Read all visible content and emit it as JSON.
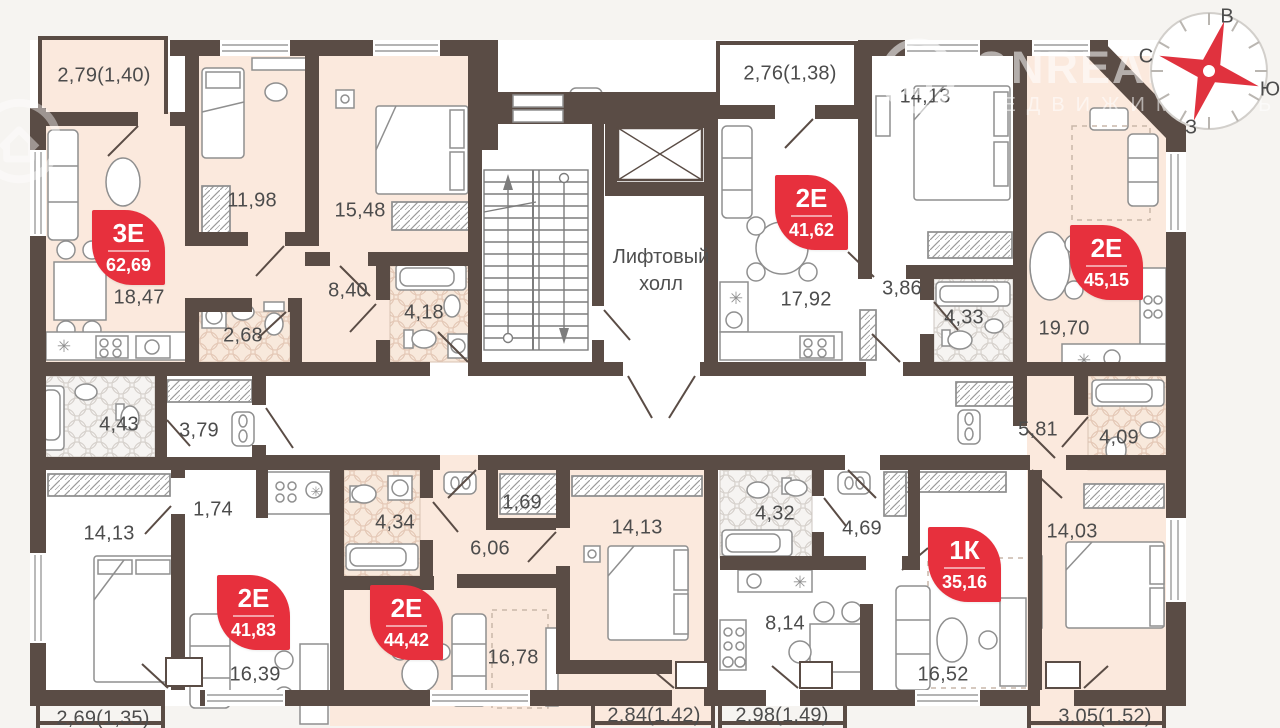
{
  "watermark": {
    "brand": "ONREALT",
    "subtitle": "НЕДВИЖИМОСТЬ"
  },
  "compass": {
    "top": "В",
    "left": "С",
    "right": "Ю",
    "bottom": "З"
  },
  "core": {
    "lift_hall": "Лифтовый холл"
  },
  "colors": {
    "wall": "#5a4c45",
    "accent_red": "#e7303d",
    "room_warm": "#fbe9dd",
    "room_white": "#ffffff",
    "tile_warm": "#f8e9dc",
    "tile_cool": "#f6f4f2",
    "background": "#f6f4f1",
    "furniture_line": "#8f8f8f",
    "label_text": "#4c4c4c"
  },
  "apartments": [
    {
      "type_label": "3Е",
      "area": "62,69",
      "x": 92,
      "y": 210
    },
    {
      "type_label": "2Е",
      "area": "41,62",
      "x": 775,
      "y": 175
    },
    {
      "type_label": "2Е",
      "area": "45,15",
      "x": 1070,
      "y": 225
    },
    {
      "type_label": "2Е",
      "area": "41,83",
      "x": 217,
      "y": 575
    },
    {
      "type_label": "2Е",
      "area": "44,42",
      "x": 370,
      "y": 585
    },
    {
      "type_label": "1К",
      "area": "35,16",
      "x": 928,
      "y": 527
    }
  ],
  "room_labels": [
    {
      "text": "2,79(1,40)",
      "x": 104,
      "y": 76
    },
    {
      "text": "11,98",
      "x": 252,
      "y": 201
    },
    {
      "text": "15,48",
      "x": 360,
      "y": 211
    },
    {
      "text": "18,47",
      "x": 139,
      "y": 298
    },
    {
      "text": "2,68",
      "x": 243,
      "y": 336
    },
    {
      "text": "8,40",
      "x": 348,
      "y": 291
    },
    {
      "text": "4,18",
      "x": 424,
      "y": 313
    },
    {
      "text": "2,76(1,38)",
      "x": 790,
      "y": 74
    },
    {
      "text": "14,13",
      "x": 925,
      "y": 97
    },
    {
      "text": "17,92",
      "x": 806,
      "y": 300
    },
    {
      "text": "3,86",
      "x": 902,
      "y": 289
    },
    {
      "text": "4,33",
      "x": 964,
      "y": 318
    },
    {
      "text": "19,70",
      "x": 1064,
      "y": 329
    },
    {
      "text": "5,81",
      "x": 1038,
      "y": 430
    },
    {
      "text": "4,09",
      "x": 1119,
      "y": 438
    },
    {
      "text": "4,43",
      "x": 119,
      "y": 425
    },
    {
      "text": "3,79",
      "x": 199,
      "y": 431
    },
    {
      "text": "1,74",
      "x": 213,
      "y": 510
    },
    {
      "text": "14,13",
      "x": 109,
      "y": 534
    },
    {
      "text": "16,39",
      "x": 255,
      "y": 675
    },
    {
      "text": "2,69(1,35)",
      "x": 103,
      "y": 719
    },
    {
      "text": "4,34",
      "x": 395,
      "y": 523
    },
    {
      "text": "6,06",
      "x": 490,
      "y": 549
    },
    {
      "text": "1,69",
      "x": 522,
      "y": 503
    },
    {
      "text": "16,78",
      "x": 513,
      "y": 658
    },
    {
      "text": "14,13",
      "x": 637,
      "y": 528
    },
    {
      "text": "2,84(1,42)",
      "x": 654,
      "y": 716
    },
    {
      "text": "4,32",
      "x": 775,
      "y": 514
    },
    {
      "text": "4,69",
      "x": 862,
      "y": 529
    },
    {
      "text": "8,14",
      "x": 785,
      "y": 624
    },
    {
      "text": "16,52",
      "x": 943,
      "y": 675
    },
    {
      "text": "2,98(1,49)",
      "x": 782,
      "y": 716
    },
    {
      "text": "14,03",
      "x": 1072,
      "y": 532
    },
    {
      "text": "3,05(1,52)",
      "x": 1105,
      "y": 717
    }
  ]
}
